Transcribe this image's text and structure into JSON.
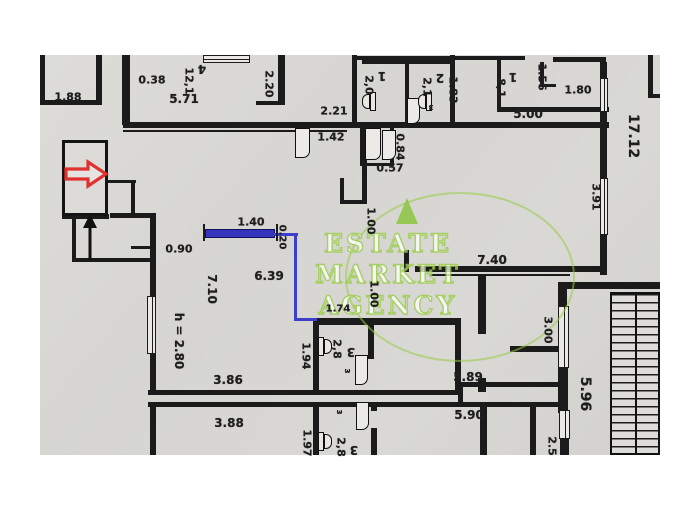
{
  "title": "apartment floor plan scan",
  "watermark": {
    "line1": "ESTATE",
    "line2": "MARKET",
    "line3": "AGENCY"
  },
  "colors": {
    "paper": "#d8d7d4",
    "wall": "#1b1b1b",
    "blue_marking": "#3d3fc8",
    "watermark_green": "#9ccf4b",
    "entrance_arrow_red": "#e0312e"
  },
  "height_note": "h = 2.80",
  "labels": [
    {
      "t": "1.88",
      "x": 68,
      "y": 97,
      "r": 0,
      "k": "dimension"
    },
    {
      "t": "0.38",
      "x": 152,
      "y": 80,
      "r": 0,
      "k": "dimension"
    },
    {
      "t": "5.71",
      "x": 184,
      "y": 99,
      "r": 0,
      "s": 12,
      "k": "dimension"
    },
    {
      "t": "12,1",
      "x": 189,
      "y": 81,
      "r": 90,
      "k": "room-area"
    },
    {
      "t": "4",
      "x": 202,
      "y": 69,
      "r": 180,
      "s": 12,
      "k": "room-number"
    },
    {
      "t": "2.20",
      "x": 269,
      "y": 84,
      "r": 90,
      "k": "dimension"
    },
    {
      "t": "2.21",
      "x": 334,
      "y": 111,
      "r": 0,
      "k": "dimension"
    },
    {
      "t": "1.42",
      "x": 331,
      "y": 137,
      "r": 0,
      "k": "dimension"
    },
    {
      "t": "0.57",
      "x": 390,
      "y": 168,
      "r": 0,
      "k": "dimension"
    },
    {
      "t": "0.84",
      "x": 400,
      "y": 147,
      "r": 90,
      "k": "dimension"
    },
    {
      "t": "2,0",
      "x": 369,
      "y": 85,
      "r": 90,
      "k": "room-area"
    },
    {
      "t": "1",
      "x": 382,
      "y": 76,
      "r": 180,
      "s": 12,
      "k": "room-number"
    },
    {
      "t": "2,1",
      "x": 427,
      "y": 87,
      "r": 90,
      "k": "room-area"
    },
    {
      "t": "2",
      "x": 440,
      "y": 78,
      "r": 180,
      "s": 12,
      "k": "room-number"
    },
    {
      "t": "ɜ",
      "x": 431,
      "y": 107,
      "r": 180,
      "s": 9,
      "k": "glyph"
    },
    {
      "t": "1.83",
      "x": 453,
      "y": 90,
      "r": 90,
      "k": "dimension"
    },
    {
      "t": "8,1",
      "x": 501,
      "y": 88,
      "r": 90,
      "k": "room-area"
    },
    {
      "t": "1",
      "x": 513,
      "y": 77,
      "r": 180,
      "s": 12,
      "k": "room-number"
    },
    {
      "t": "1.56",
      "x": 542,
      "y": 77,
      "r": 90,
      "k": "dimension"
    },
    {
      "t": "1.80",
      "x": 578,
      "y": 90,
      "r": 0,
      "k": "dimension"
    },
    {
      "t": "5.00",
      "x": 528,
      "y": 114,
      "r": 0,
      "s": 12,
      "k": "dimension"
    },
    {
      "t": "17.12",
      "x": 633,
      "y": 136,
      "r": 90,
      "s": 14,
      "k": "dimension"
    },
    {
      "t": "3.91",
      "x": 596,
      "y": 197,
      "r": 90,
      "k": "dimension"
    },
    {
      "t": "1.40",
      "x": 251,
      "y": 222,
      "r": 0,
      "k": "dimension"
    },
    {
      "t": "0.20",
      "x": 282,
      "y": 237,
      "r": 90,
      "s": 10,
      "k": "dimension"
    },
    {
      "t": "0.90",
      "x": 179,
      "y": 249,
      "r": 0,
      "k": "dimension"
    },
    {
      "t": "6.39",
      "x": 269,
      "y": 276,
      "r": 0,
      "s": 12,
      "k": "dimension"
    },
    {
      "t": "7.10",
      "x": 212,
      "y": 289,
      "r": 90,
      "s": 12,
      "k": "dimension"
    },
    {
      "t": "1.00",
      "x": 371,
      "y": 221,
      "r": 90,
      "k": "dimension"
    },
    {
      "t": "1.00",
      "x": 374,
      "y": 294,
      "r": 90,
      "k": "dimension"
    },
    {
      "t": "7.40",
      "x": 492,
      "y": 260,
      "r": 0,
      "s": 12,
      "k": "dimension"
    },
    {
      "t": "1.74",
      "x": 338,
      "y": 309,
      "r": 0,
      "s": 10,
      "k": "dimension"
    },
    {
      "t": "h = 2.80",
      "x": 179,
      "y": 341,
      "r": 90,
      "s": 12,
      "k": "note"
    },
    {
      "t": "1.94",
      "x": 306,
      "y": 356,
      "r": 90,
      "k": "dimension"
    },
    {
      "t": "2,8",
      "x": 337,
      "y": 349,
      "r": 90,
      "k": "room-area"
    },
    {
      "t": "3",
      "x": 351,
      "y": 352,
      "r": 180,
      "s": 12,
      "k": "room-number"
    },
    {
      "t": "ɜ",
      "x": 347,
      "y": 371,
      "r": 90,
      "s": 9,
      "k": "glyph"
    },
    {
      "t": "3.00",
      "x": 548,
      "y": 330,
      "r": 90,
      "k": "dimension"
    },
    {
      "t": "3.86",
      "x": 228,
      "y": 380,
      "r": 0,
      "s": 12,
      "k": "dimension"
    },
    {
      "t": "5.89",
      "x": 468,
      "y": 377,
      "r": 0,
      "s": 12,
      "k": "dimension"
    },
    {
      "t": "5.96",
      "x": 585,
      "y": 394,
      "r": 90,
      "s": 14,
      "k": "dimension"
    },
    {
      "t": "3.88",
      "x": 229,
      "y": 423,
      "r": 0,
      "s": 12,
      "k": "dimension"
    },
    {
      "t": "5.90",
      "x": 469,
      "y": 415,
      "r": 0,
      "s": 12,
      "k": "dimension"
    },
    {
      "t": "1.97",
      "x": 307,
      "y": 443,
      "r": 90,
      "k": "dimension"
    },
    {
      "t": "2,8",
      "x": 341,
      "y": 447,
      "r": 90,
      "k": "room-area"
    },
    {
      "t": "3",
      "x": 354,
      "y": 450,
      "r": 180,
      "s": 12,
      "k": "room-number"
    },
    {
      "t": "ɜ",
      "x": 339,
      "y": 412,
      "r": 90,
      "s": 9,
      "k": "glyph"
    },
    {
      "t": "2.5",
      "x": 552,
      "y": 446,
      "r": 90,
      "k": "dimension"
    }
  ]
}
